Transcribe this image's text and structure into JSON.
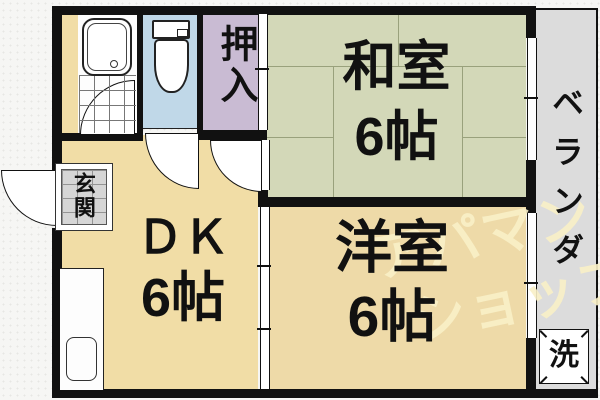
{
  "rooms": {
    "washitsu": {
      "name": "和室",
      "size": "6帖"
    },
    "youshitsu": {
      "name": "洋室",
      "size": "6帖"
    },
    "dk": {
      "name": "ＤＫ",
      "size": "6帖"
    },
    "oshiire": {
      "name": "押入"
    },
    "genkan": {
      "name": "玄関"
    },
    "veranda": {
      "name": "ベランダ"
    },
    "laundry": {
      "name": "洗"
    }
  },
  "watermark": {
    "line1": "アパマン",
    "line2": "ショップ"
  },
  "colors": {
    "wall": "#111111",
    "dk_floor": "#f1dda6",
    "tatami_floor": "#d3d8b8",
    "western_floor": "#eedaa8",
    "toilet_floor": "#c0d8e8",
    "closet_floor": "#c9bbd3",
    "veranda_floor": "#dcdcdc",
    "genkan_tile": "#d6d6d6",
    "watermark_text": "#f8f0c6"
  }
}
